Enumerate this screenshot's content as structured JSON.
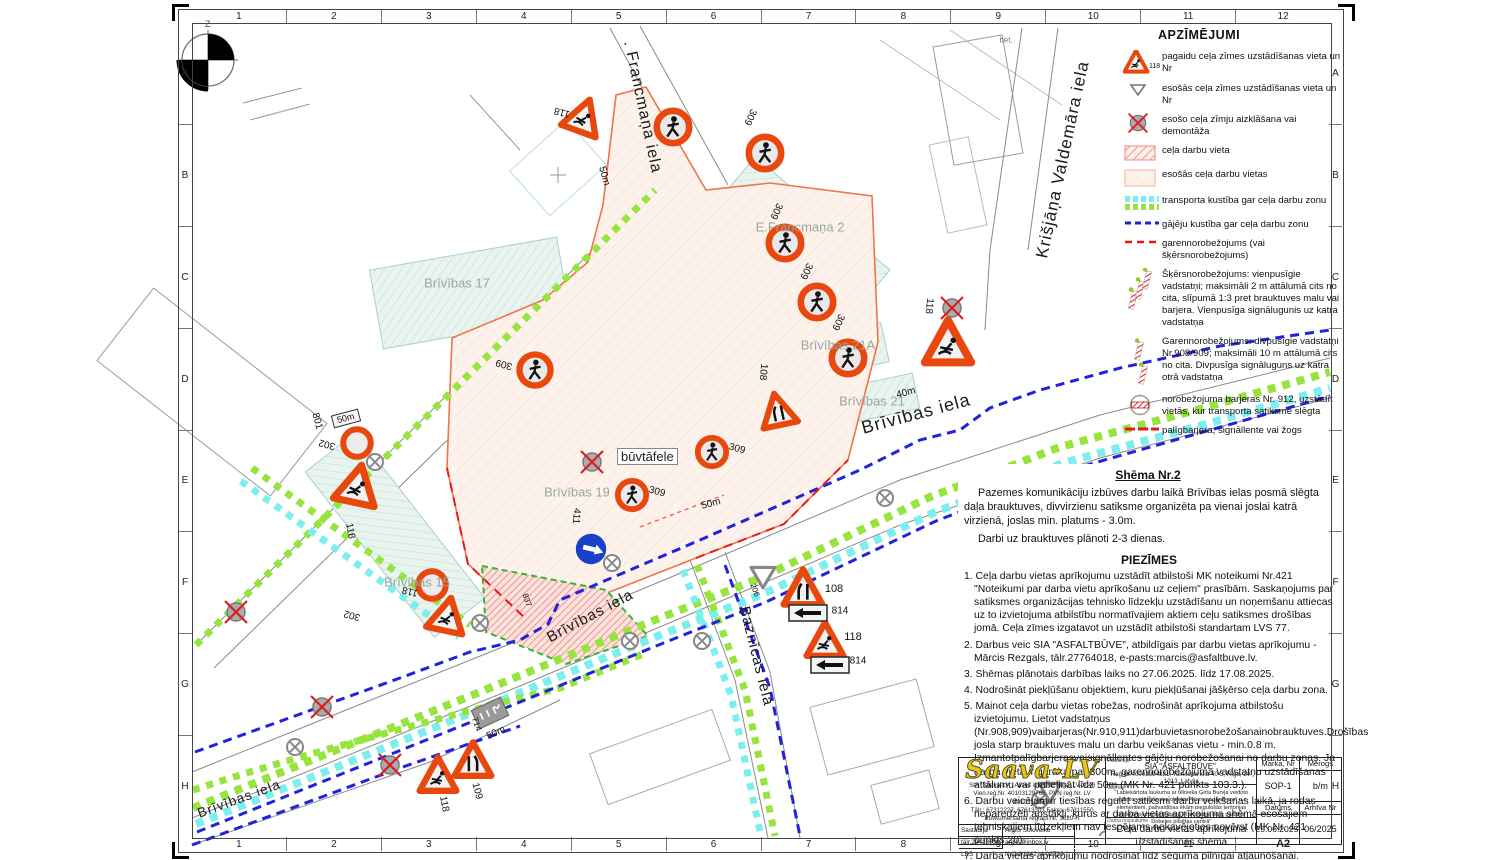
{
  "sheet": {
    "grid_top": [
      "1",
      "2",
      "3",
      "4",
      "5",
      "6",
      "7",
      "8",
      "9",
      "10",
      "11",
      "12"
    ],
    "grid_bottom": [
      "1",
      "2",
      "3",
      "4",
      "5",
      "6",
      "7",
      "8",
      "9",
      "10",
      "11",
      "A2"
    ],
    "grid_left": [
      "A",
      "B",
      "C",
      "D",
      "E",
      "F",
      "G",
      "H"
    ],
    "grid_right": [
      "A",
      "B",
      "C",
      "D",
      "E",
      "F",
      "G",
      "H"
    ],
    "north_label": "Z"
  },
  "map": {
    "streets": [
      "Brīvības iela",
      "Brīvības iela",
      "Brīvības iela",
      ". Francmaņa iela",
      "Krišjāņa Valdemāra iela",
      "Baznīcas iela"
    ],
    "buildings": [
      "Brīvības 17",
      "E.Francmaņa 2",
      "Brīvības 21A",
      "Brīvības 21",
      "Brīvības 19",
      "Brīvības 15"
    ],
    "builder_board": "būvtāfele",
    "tags": [
      "118",
      "309",
      "309",
      "309",
      "309",
      "118",
      "309",
      "108",
      "309",
      "309",
      "411",
      "801",
      "302",
      "118",
      "118",
      "302",
      "109",
      "118",
      "714",
      "50m",
      "50m",
      "50m",
      "40m",
      "108",
      "814",
      "118",
      "814",
      "206",
      "837",
      "50m",
      "bet."
    ]
  },
  "legend": {
    "title": "APZĪMĒJUMI",
    "items": [
      {
        "no": "118",
        "text": "pagaidu ceļa zīmes uzstādīšanas vieta un Nr"
      },
      {
        "no": "",
        "text": "esošās ceļa zīmes uzstādīšanas vieta un Nr"
      },
      {
        "no": "",
        "text": "esošo ceļa zīmju aizklāšana vai demontāža"
      },
      {
        "no": "",
        "text": "ceļa darbu vieta"
      },
      {
        "no": "",
        "text": "esošās ceļa darbu vietas"
      },
      {
        "no": "",
        "text": "transporta kustība gar ceļa darbu zonu"
      },
      {
        "no": "",
        "text": "gājēju kustība gar ceļa darbu zonu"
      },
      {
        "no": "",
        "text": "garennorobežojums (vai šķērsnorobežojums)"
      },
      {
        "no": "",
        "text": "Šķērsnorobežojums: vienpusīgie vadstatņi; maksimāli 2 m attālumā cits no cita, slīpumā 1:3 pret brauktuves malu vai barjera. Vienpusīga signālugunis uz katra vadstatņa"
      },
      {
        "no": "",
        "text": "Garennorobežojums: divpusīgie vadstatņi Nr.908/909; maksimāli 10 m attālumā cits no cita. Divpusīga signāluguns uz katra otrā vadstatņa"
      },
      {
        "no": "",
        "text": "norobežojuma barjeras Nr. 912, uzstādīt vietās, kur transporta satiksme slēgta"
      },
      {
        "no": "",
        "text": "palīgbarjera, signāllente vai žogs"
      }
    ]
  },
  "scheme": {
    "title": "Shēma Nr.2",
    "p1": "Pazemes komunikāciju izbūves darbu laikā Brīvības ielas posmā slēgta daļa brauktuves, divvirzienu satiksme organizēta pa vienai joslai katrā virzienā, joslas min. platums - 3.0m.",
    "p2": "Darbi uz brauktuves plānoti 2-3 dienas.",
    "p3": "Darbi turpinās centrāla laukumā."
  },
  "notes": {
    "title": "PIEZĪMES",
    "items": [
      "1. Ceļa darbu vietas aprīkojumu uzstādīt atbilstoši MK noteikumi Nr.421 \"Noteikumi par darba vietu aprīkošanu uz ceļiem\" prasībām. Saskaņojums par satiksmes organizācijas tehnisko līdzekļu uzstādīšanu un noņemšanu attiecas uz to izvietojuma atbilstību normatīvajiem aktiem ceļu satiksmes drošības jomā. Ceļa zīmes izgatavot un uzstādīt atbilstoši standartam LVS 77.",
      "2. Darbus veic SIA \"ASFALTBŪVE\", atbildīgais par darbu vietas aprīkojumu - Mārcis Rezgals, tālr.27764018, e-pasts:marcis@asfaltbuve.lv.",
      "3. Shēmas plānotais darbības laiks no 27.06.2025. līdz 17.08.2025.",
      "4. Nodrošināt piekļūšanu objektiem, kuru piekļūšanai jāšķērso ceļa darbu zona.",
      "5. Mainot ceļa darbu vietas robežas, nodrošināt aprīkojuma atbilstošu izvietojumu. Lietot vadstatņus (Nr.908,909)vaibarjeras(Nr.910,911)darbuvietasnorobežošanainobrauktuves.Drošības josla starp brauktuves malu un darbu veikšanas vietu - min.0.8 m. Izmantotpalīgbarjerasvaisignāllentes gājēju norobežošanai no darbu zonas. Ja darba vieta ir garāka par 300m, garennorobežojuma vadstatņu uzstādīšanas attālumu var palielināt līdz 50m (MK Nr. 421 punkts 103.3.).",
      "6. Darbu veicējam ir tiesības regulēt satiksmi darbu veikšanas laikā, ja rodas neparedzēti apstākļi, kurus ar darba vietas aprīkojuma shēmā esošajiem tehniskajiem līdzekļiem nav iespējams nekavējoties novērst (MK Nr. 421 punkts 20).",
      "7. Darba vietas aprīkojumu nodrošināt līdz seguma pilnīgai atjaunošanai."
    ]
  },
  "titleblock": {
    "logo": "Saava-LV",
    "company_lines": [
      "SIA \"Saava-LV\", Alises iela 2 a, Rīga, LV-1046",
      "Vien.reģ.Nr. 40103129768, PVN reģ.Nr. LV 40103129768",
      "Tālr.: 67312227, 67613303 Fakss: 67311550",
      "Būvkomersanta reģ.apl.Nr. 3620-R"
    ],
    "left_rows": [
      [
        "Sastādīja",
        "Argils Soloveiko"
      ],
      [
        "tālr.29413632",
        "argils@inbox.lv"
      ],
      [
        "LBS būvpr.sert.",
        "Nr.3-01342; 4-02739"
      ]
    ],
    "client_label": "Pasūtītājs",
    "client_line1": "SIA \"ASFALTBŪVE\",",
    "client_line2": "Reģ.Nr.40003994881, Tomsona iela 40-3, Rīga, LV-1013, Latvija",
    "object_label": "Objekts",
    "object_text": "\"Labiekārtota laukuma ar tēlnieka Ģirta Burvja veidoto centrālo vides dizaina objektu \"Nameja gredzens\" u.c. elementiem, pašvaldības ēkām piegulošās teritorijas labiekārtojuma un Edgara Francmaņa ielas pārbūve Dobeles pilsētas centrā\"",
    "work_label": "Darba nosaukums",
    "work_title": "Ceļa darbu vietas aprīkojuma uzstādīšanas shēma",
    "fields": {
      "marka_label": "Marka, Nr",
      "marka": "SOP-1",
      "merogs_label": "Mērogs",
      "merogs": "b/m",
      "datums_label": "Datums",
      "datums": "25.06.2025.",
      "arhivs_label": "Arhīva Nr",
      "arhivs": "06/2025"
    }
  },
  "colors": {
    "sign_orange": "#e8480e",
    "mandatory_blue": "#1742c8",
    "pedestrian_blue": "#2222dd",
    "transport_green": "#97e43f",
    "transport_cyan": "#7deef0",
    "workzone_border": "#f0734a",
    "barrier_red": "#e81818"
  }
}
